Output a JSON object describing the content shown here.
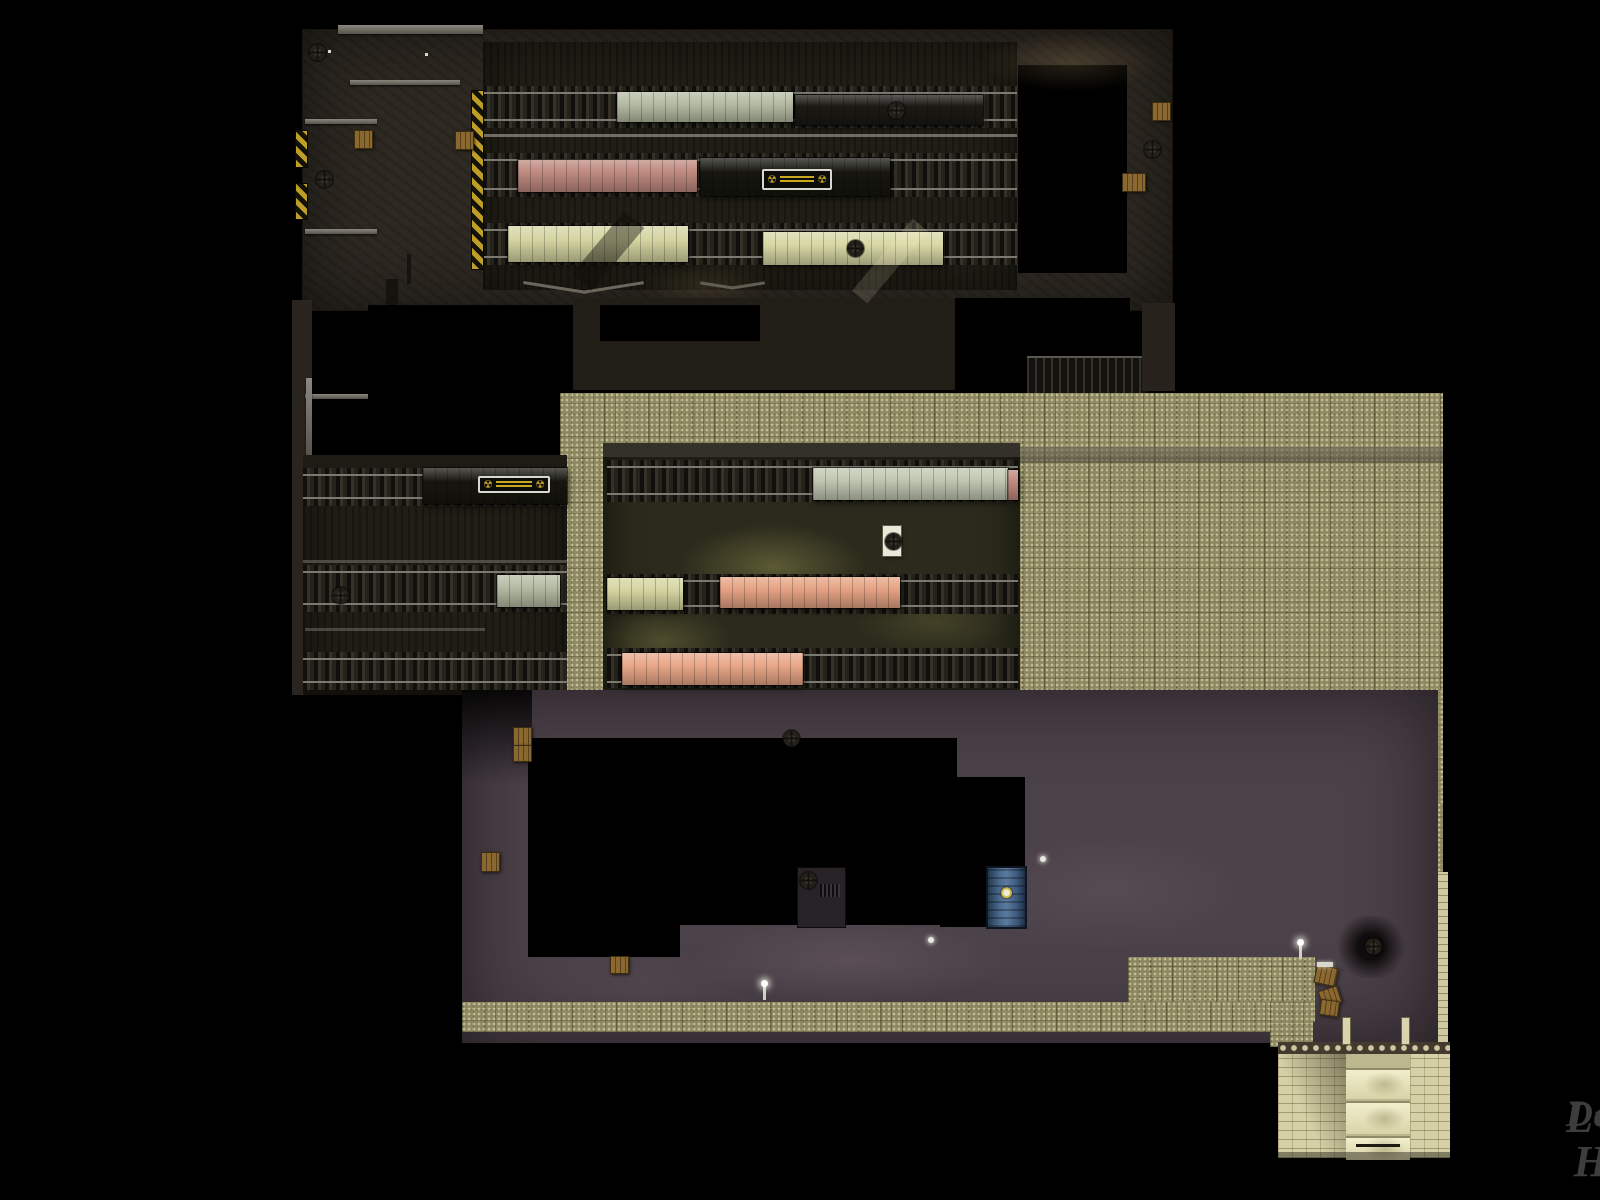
{
  "title": "Overhead level map — train depot",
  "watermark": {
    "line1": "LvL HD",
    "line2": "Database"
  },
  "palette": {
    "khaki": "#8d8861",
    "purple": "#4b4148",
    "brown": "#2e2922",
    "rail": "#7b7970",
    "hazard": "#bd9f28",
    "watermark": "#3d3d3d",
    "car_white": "#b6bca4",
    "car_pink": "#bf8a7f",
    "car_cream": "#d5d5a2",
    "car_salmon": "#e7a484",
    "car_dark": "#16150f",
    "brick": "#d6d0a6",
    "door_blue": "#49688c"
  },
  "icons": {
    "fan-icon": "circular vent fan (cross blades)",
    "radiation-icon": "☢",
    "lamp-icon": "white light point",
    "crate-icon": "wooden crate"
  },
  "map": {
    "symbols": {
      "radiation": "☢"
    },
    "props": {
      "cars": [
        {
          "x": 617,
          "y": 92,
          "w": 176,
          "h": 30,
          "c": "#b6bca4",
          "name": "railcar-white-top"
        },
        {
          "x": 795,
          "y": 95,
          "w": 188,
          "h": 30,
          "c": "#1a1914",
          "name": "railcar-dark-top"
        },
        {
          "x": 518,
          "y": 160,
          "w": 179,
          "h": 32,
          "c": "#bf8a7f",
          "name": "railcar-pink-top"
        },
        {
          "x": 700,
          "y": 158,
          "w": 190,
          "h": 38,
          "c": "#16150f",
          "name": "railcar-dark-radiation-top"
        },
        {
          "x": 508,
          "y": 226,
          "w": 180,
          "h": 36,
          "c": "#d5d5a2",
          "name": "railcar-cream-top-1"
        },
        {
          "x": 763,
          "y": 232,
          "w": 180,
          "h": 33,
          "c": "#d8d8a6",
          "name": "railcar-cream-top-2"
        },
        {
          "x": 423,
          "y": 468,
          "w": 144,
          "h": 36,
          "c": "#16150f",
          "name": "railcar-dark-radiation-mid"
        },
        {
          "x": 497,
          "y": 575,
          "w": 63,
          "h": 32,
          "c": "#b6bca4",
          "name": "railcar-white-mid"
        },
        {
          "x": 813,
          "y": 468,
          "w": 195,
          "h": 32,
          "c": "#c2c7b2",
          "name": "railcar-white-shed"
        },
        {
          "x": 1008,
          "y": 470,
          "w": 10,
          "h": 30,
          "c": "#bf8a7f",
          "name": "railcar-pink-stub-shed"
        },
        {
          "x": 607,
          "y": 578,
          "w": 76,
          "h": 32,
          "c": "#d5d5a2",
          "name": "railcar-cream-shed"
        },
        {
          "x": 720,
          "y": 577,
          "w": 180,
          "h": 31,
          "c": "#e7a484",
          "name": "railcar-salmon-shed-1"
        },
        {
          "x": 622,
          "y": 653,
          "w": 181,
          "h": 32,
          "c": "#eaa888",
          "name": "railcar-salmon-shed-2"
        }
      ],
      "overlays": [
        {
          "x": 595,
          "y": 210,
          "w": 26,
          "h": 82,
          "rot": 40,
          "c": "rgba(15,13,8,.42)",
          "name": "shadow-beam"
        },
        {
          "x": 880,
          "y": 214,
          "w": 20,
          "h": 94,
          "rot": 40,
          "c": "rgba(255,250,210,.14)",
          "name": "light-beam"
        }
      ],
      "signs": [
        {
          "x": 762,
          "y": 169,
          "w": 70,
          "h": 21,
          "name": "radiation-sign-top"
        },
        {
          "x": 478,
          "y": 476,
          "w": 72,
          "h": 17,
          "name": "radiation-sign-mid"
        }
      ],
      "white_boxes": [
        {
          "x": 883,
          "y": 526,
          "w": 18,
          "h": 30,
          "name": "white-vent-box"
        }
      ],
      "fans": [
        {
          "x": 309,
          "y": 44
        },
        {
          "x": 316,
          "y": 171
        },
        {
          "x": 888,
          "y": 102
        },
        {
          "x": 847,
          "y": 240
        },
        {
          "x": 1144,
          "y": 141
        },
        {
          "x": 332,
          "y": 587
        },
        {
          "x": 885,
          "y": 533
        },
        {
          "x": 783,
          "y": 730
        },
        {
          "x": 800,
          "y": 872
        },
        {
          "x": 1365,
          "y": 938
        }
      ],
      "crates": [
        {
          "x": 354,
          "y": 130
        },
        {
          "x": 455,
          "y": 131
        },
        {
          "x": 1152,
          "y": 102
        },
        {
          "x": 1122,
          "y": 173,
          "w": 24
        },
        {
          "x": 513,
          "y": 727
        },
        {
          "x": 513,
          "y": 745,
          "h": 17
        },
        {
          "x": 481,
          "y": 852,
          "h": 20
        },
        {
          "x": 610,
          "y": 956,
          "h": 18
        },
        {
          "x": 1315,
          "y": 966,
          "w": 22,
          "rot": 12
        },
        {
          "x": 1320,
          "y": 988,
          "w": 20,
          "h": 18,
          "rot": -18
        },
        {
          "x": 1320,
          "y": 1000,
          "h": 16,
          "rot": 8
        }
      ],
      "lamps": [
        {
          "x": 763,
          "y": 985,
          "cls": "post"
        },
        {
          "x": 1299,
          "y": 944,
          "cls": "post"
        },
        {
          "x": 928,
          "y": 937,
          "cls": "dot"
        },
        {
          "x": 1040,
          "y": 856,
          "cls": "dot"
        },
        {
          "x": 1317,
          "y": 962,
          "cls": "bar"
        }
      ],
      "doors": [
        {
          "x": 988,
          "y": 868,
          "w": 37,
          "h": 59,
          "name": "blue-radiation-door"
        }
      ]
    }
  }
}
